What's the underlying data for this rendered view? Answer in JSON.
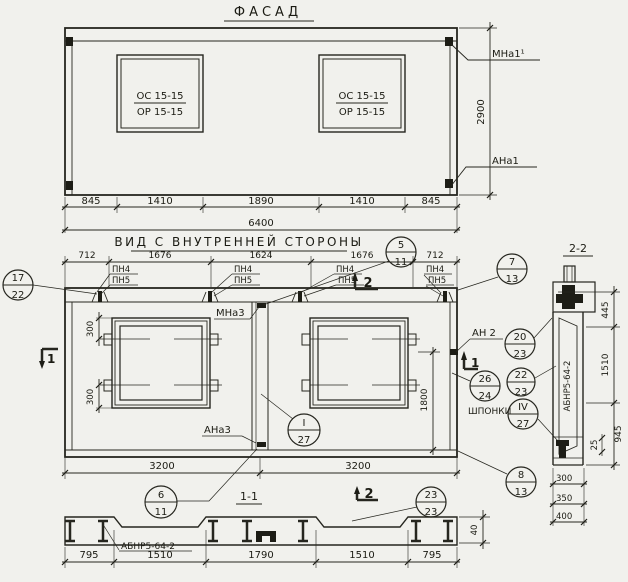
{
  "facade": {
    "title": "ФАСАД",
    "window_mark_numerator": "ОС 15-15",
    "window_mark_denominator": "ОР 15-15",
    "label_mna1": "МНа1¹",
    "label_ana1": "АНа1",
    "dim_height": "2900",
    "dims_bottom": [
      "845",
      "1410",
      "1890",
      "1410",
      "845"
    ],
    "dim_total": "6400"
  },
  "inner_view": {
    "title": "ВИД С ВНУТРЕННЕЙ СТОРОНЫ",
    "dims_top": [
      "712",
      "1676",
      "1624",
      "1676",
      "712"
    ],
    "label_pn4": "ПН4",
    "label_pn5": "ПН5",
    "label_mna3": "МНа3",
    "label_ana3": "АНа3",
    "label_an2": "АН 2",
    "label_shponki": "ШПОНКИ",
    "dim_300": "300",
    "dim_1800": "1800",
    "dims_bottom": [
      "3200",
      "3200"
    ],
    "marker_1": "1",
    "marker_2": "2"
  },
  "callouts": {
    "c17_22": {
      "top": "17",
      "bottom": "22"
    },
    "c5_11": {
      "top": "5",
      "bottom": "11"
    },
    "c7_13": {
      "top": "7",
      "bottom": "13"
    },
    "c20_23": {
      "top": "20",
      "bottom": "23"
    },
    "c26_24": {
      "top": "26",
      "bottom": "24"
    },
    "c22_23": {
      "top": "22",
      "bottom": "23"
    },
    "c4_27": {
      "top": "IV",
      "bottom": "27"
    },
    "c8_13": {
      "top": "8",
      "bottom": "13"
    },
    "c1_27": {
      "top": "I",
      "bottom": "27"
    },
    "c6_11": {
      "top": "6",
      "bottom": "11"
    },
    "c23_23": {
      "top": "23",
      "bottom": "23"
    }
  },
  "section_1_1": {
    "title": "1-1",
    "label_beam": "АБНР5-64-2",
    "dims_bottom": [
      "795",
      "1510",
      "1790",
      "1510",
      "795"
    ],
    "dim_40": "40"
  },
  "section_2_2": {
    "title": "2-2",
    "label_beam": "АБНР5-64-2",
    "dim_445": "445",
    "dim_1510": "1510",
    "dim_945": "945",
    "dim_25": "25",
    "dims_variants": [
      "300",
      "350",
      "400"
    ]
  }
}
